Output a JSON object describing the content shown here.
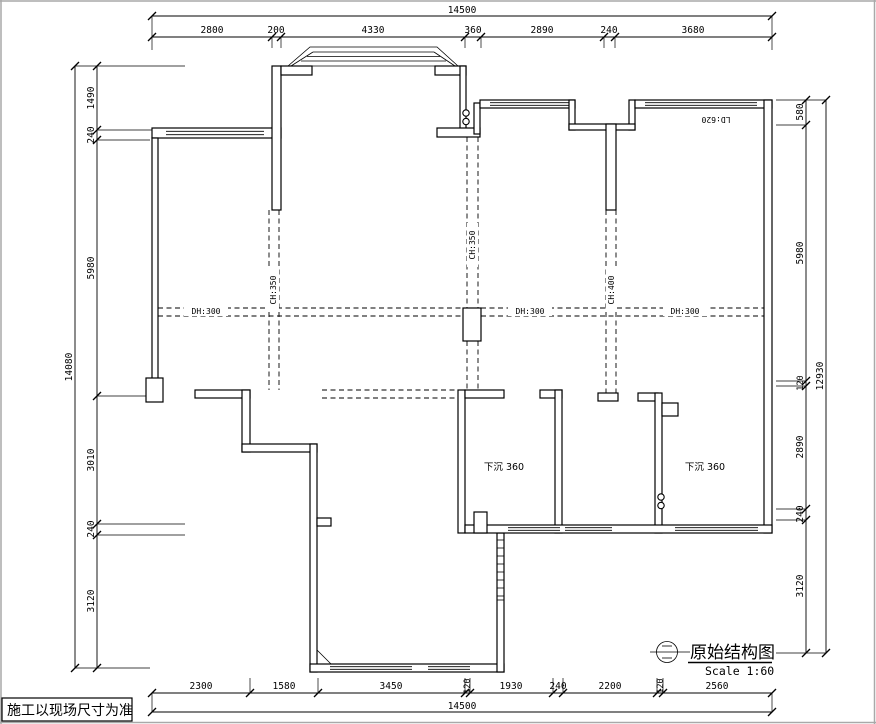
{
  "frame": {
    "note": "施工以现场尺寸为准"
  },
  "title_block": {
    "title": "原始结构图",
    "scale": "Scale 1:60"
  },
  "plan_labels": {
    "ld_window": "LD:620",
    "sunken_left": "下沉 360",
    "sunken_right": "下沉 360",
    "beam_h1": "DH:300",
    "beam_h2": "DH:300",
    "beam_h3": "DH:300",
    "beam_v1": "CH:350",
    "beam_v2": "CH:350",
    "beam_v3": "CH:400"
  },
  "dimensions": {
    "top_total": "14500",
    "top": [
      "2800",
      "200",
      "4330",
      "360",
      "2890",
      "240",
      "3680"
    ],
    "bottom": [
      "2300",
      "1580",
      "3450",
      "120",
      "1930",
      "240",
      "2200",
      "120",
      "2560"
    ],
    "bottom_total": "14500",
    "left_total": "14080",
    "left": [
      "1490",
      "240",
      "5980",
      "3010",
      "240",
      "3120"
    ],
    "right": [
      "580",
      "5980",
      "120",
      "2890",
      "240",
      "3120"
    ],
    "right_total": "12930"
  }
}
